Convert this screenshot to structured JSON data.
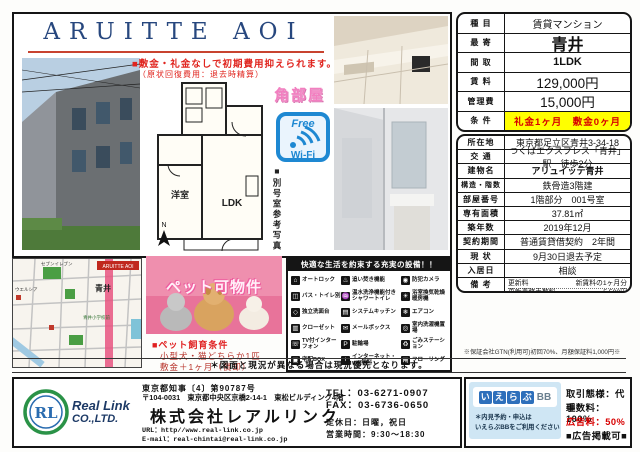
{
  "page": {
    "title": "ARUITTE AOI",
    "catch1": "■敷金・礼金なしで初期費用抑えられます。",
    "catch2": "（原状回復費用：退去時精算）",
    "corner_room": "角部屋",
    "wifi_free": "Free",
    "wifi_label": "Wi-Fi",
    "photo_note": "■別号室参考写真",
    "compass_n": "N"
  },
  "floorplan": {
    "room_west": "洋室",
    "room_ldk": "LDK"
  },
  "map": {
    "tag": "ARUITTE AOI",
    "station": "青井",
    "labels": {
      "conv": "セブンイレブン",
      "drug": "ウエルシア",
      "school": "青井小学校前"
    }
  },
  "pet": {
    "banner": "ペット可物件",
    "heading": "■ペット飼育条件",
    "cond1": "小型犬・猫どちらか1匹",
    "cond2": "敷金＋1ヶ月（償却）"
  },
  "equipment": {
    "header": "快適な生活を約束する充実の設備！！",
    "items": [
      {
        "label": "オートロック",
        "glyph": "⌂"
      },
      {
        "label": "追い焚き機能",
        "glyph": "♨"
      },
      {
        "label": "防犯カメラ",
        "glyph": "◉"
      },
      {
        "label": "バス・トイレ別",
        "glyph": "◫"
      },
      {
        "label": "温水洗浄機能付き シャワートイレ",
        "glyph": "♒"
      },
      {
        "label": "浴室換気乾燥暖房機",
        "glyph": "☀"
      },
      {
        "label": "独立洗面台",
        "glyph": "◇"
      },
      {
        "label": "システムキッチン",
        "glyph": "▤"
      },
      {
        "label": "エアコン",
        "glyph": "❄"
      },
      {
        "label": "クローゼット",
        "glyph": "▥"
      },
      {
        "label": "メールボックス",
        "glyph": "✉"
      },
      {
        "label": "室内洗濯機置場",
        "glyph": "◎"
      },
      {
        "label": "TV付インターフォン",
        "glyph": "☏"
      },
      {
        "label": "駐輪場",
        "glyph": "P"
      },
      {
        "label": "ごみステーション",
        "glyph": "♻"
      },
      {
        "label": "宅配BOX",
        "glyph": "▣"
      },
      {
        "label": "インターネット・wifi無料",
        "glyph": "i"
      },
      {
        "label": "フローリング",
        "glyph": "▦"
      }
    ]
  },
  "summary": {
    "rows": [
      {
        "label": "種 目",
        "value": "賃貸マンション"
      },
      {
        "label": "最 寄",
        "value": "青井"
      },
      {
        "label": "間 取",
        "value": "1LDK"
      },
      {
        "label": "賃 料",
        "value": "129,000円"
      },
      {
        "label": "管理費",
        "value": "15,000円"
      },
      {
        "label": "条 件",
        "value": "礼金1ヶ月　敷金0ヶ月"
      }
    ]
  },
  "detail": {
    "rows": [
      {
        "label": "所在地",
        "value": "東京都足立区青井3-34-18"
      },
      {
        "label": "交 通",
        "value": "つくばエクスプレス「青井」駅　徒歩2分"
      },
      {
        "label": "建物名",
        "value": "アリュイッテ青井"
      },
      {
        "label": "構造・階数",
        "value": "鉄骨造3階建"
      },
      {
        "label": "部屋番号",
        "value": "1階部分　001号室"
      },
      {
        "label": "専有面積",
        "value": "37.81㎡"
      },
      {
        "label": "築年数",
        "value": "2019年12月"
      },
      {
        "label": "契約期間",
        "value": "普通賃貸借契約　2年間"
      },
      {
        "label": "現 状",
        "value": "9月30日退去予定"
      },
      {
        "label": "入居日",
        "value": "相談"
      }
    ]
  },
  "remarks": {
    "label": "備 考",
    "items": [
      {
        "name": "更新料",
        "value": "新賃料の1ヶ月分"
      },
      {
        "name": "更新事務手数料",
        "value": "5,500円"
      },
      {
        "name": "解約予告",
        "value": "2ヶ月前"
      },
      {
        "name": "損害保険（2年）",
        "value": "24,000円"
      },
      {
        "name": "24時間サポート（月額）",
        "value": "1,000円"
      },
      {
        "name": "保証会社加入必須",
        "value": "全保連・Casa"
      },
      {
        "name": "契約事務手数料",
        "value": "5,500円"
      },
      {
        "name": "鍵交換費用",
        "value": "30,000円＋税"
      }
    ],
    "footnote": "＊1年未満解約時違約金あり、退去時清掃費用負担あり"
  },
  "guarantee_note": "※保証会社GTN(利用可)初回70%、月額保証料1,000円※",
  "disclaimer": "＊図面と現況が異なる場合は現況優先となります。",
  "company": {
    "logo_line1": "Real Link",
    "logo_line2": "CO.,LTD.",
    "logo_mark": "RL",
    "license": "東京都知事〔4〕第90787号",
    "address": "〒104-0031　東京都中央区京橋2-14-1　東松ビルディング4階",
    "name": "株式会社レアルリンク",
    "url": "URL：http//www.real-link.co.jp",
    "email": "E-mail：real-chintai@real-link.co.jp",
    "tel": "TEL：03-6271-0907",
    "fax": "FAX：03-6736-0650",
    "holiday": "定休日：日曜，祝日",
    "hours": "営業時間：9:30～18:30"
  },
  "agency": {
    "logo_kana": [
      "い",
      "え",
      "ら",
      "ぶ"
    ],
    "logo_bb": "BB",
    "note1": "＊内見予約・申込は",
    "note2": "いえらぶBBをご利用ください",
    "type": "取引態様：代理",
    "fee": "手数料：100%",
    "ad": "広告料：50%",
    "ad_ok": "■広告掲載可■"
  },
  "colors": {
    "accent_red": "#e0241e",
    "title_navy": "#27477e",
    "wifi_blue": "#1e88d2",
    "highlight_yellow": "#ffff00",
    "pet_pink": "#e8579a"
  }
}
